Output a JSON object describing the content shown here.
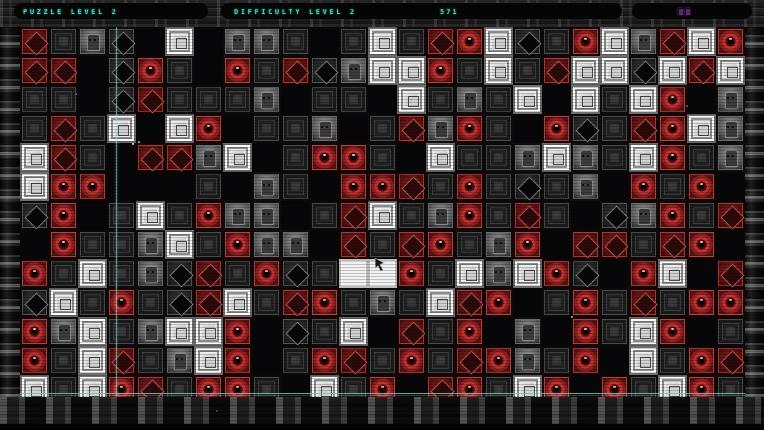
{
  "header": {
    "puzzle_label": "PUZZLE LEVEL 2",
    "difficulty_label": "DIFFICULTY LEVEL 2",
    "score": "571",
    "text_color": "#3fe8d2",
    "purple_indicator_color": "#5e2a6b"
  },
  "board": {
    "cols": 25,
    "rows": 13,
    "tile_size": 29,
    "legend": {
      ".": "empty-black",
      "d": "dark-ornate-tile",
      "D": "dark-diamond-tile",
      "f": "gray-face-tile",
      "r": "red-diamond-tile",
      "R": "red-eye-tile",
      "s": "silver-frame-tile",
      "w": "white-blank-tile"
    },
    "grid": [
      "rdfD.s.ffd.dsdrRsDdRsfrsR",
      "rr.DRd.RdrDfssRdsdrssDsrs",
      "dd.Drdddf.dd.sdfds.sdsR.f",
      "drds.sR.ddf.drfRd.RDdrRsf",
      "srd.rrfs.dRRd.sddfsfdsRdf",
      "sRR...d.fd.RRrdRdDdf.RdR.",
      "DR.dsdRff.drsdfRdrd.DfRdr",
      ".RddfsdRff.rdrRdfR.rrdrR.",
      "RdsdfDrdRDdwwRdsfsRD.Rs.r",
      "DsdRdDrsdrRdfdsrR.dRdrdRR",
      "RfsdfssR.Dds.rdR.f.RdsR.d",
      "RdsrdfsR.dRrdRdrRfdR.sdRr",
      "sdsRrdRRd.sdR.rRdsR.RdsRd"
    ],
    "colors": {
      "dark_tile": "#2a2a2a",
      "red_tile": "#86201f",
      "red_eye_ring": "#c23232",
      "silver_tile": "#e8e8e8",
      "white_tile": "#f1f1f1",
      "empty": "#070709"
    },
    "guide_lines": {
      "vertical_x": 116,
      "horizontal_y": 393,
      "color": "#96f2e6"
    },
    "specks": [
      {
        "x": 132,
        "y": 143,
        "c": "#cfcfcf"
      },
      {
        "x": 138,
        "y": 141,
        "c": "#9a9a9a"
      },
      {
        "x": 75,
        "y": 93,
        "c": "#6b4b8a"
      },
      {
        "x": 686,
        "y": 105,
        "c": "#7a3a8a"
      },
      {
        "x": 410,
        "y": 99,
        "c": "#bbbbbb"
      },
      {
        "x": 571,
        "y": 316,
        "c": "#8a8a8a"
      },
      {
        "x": 216,
        "y": 410,
        "c": "#5e2a6b"
      }
    ]
  },
  "cursor": {
    "x": 374,
    "y": 258
  }
}
